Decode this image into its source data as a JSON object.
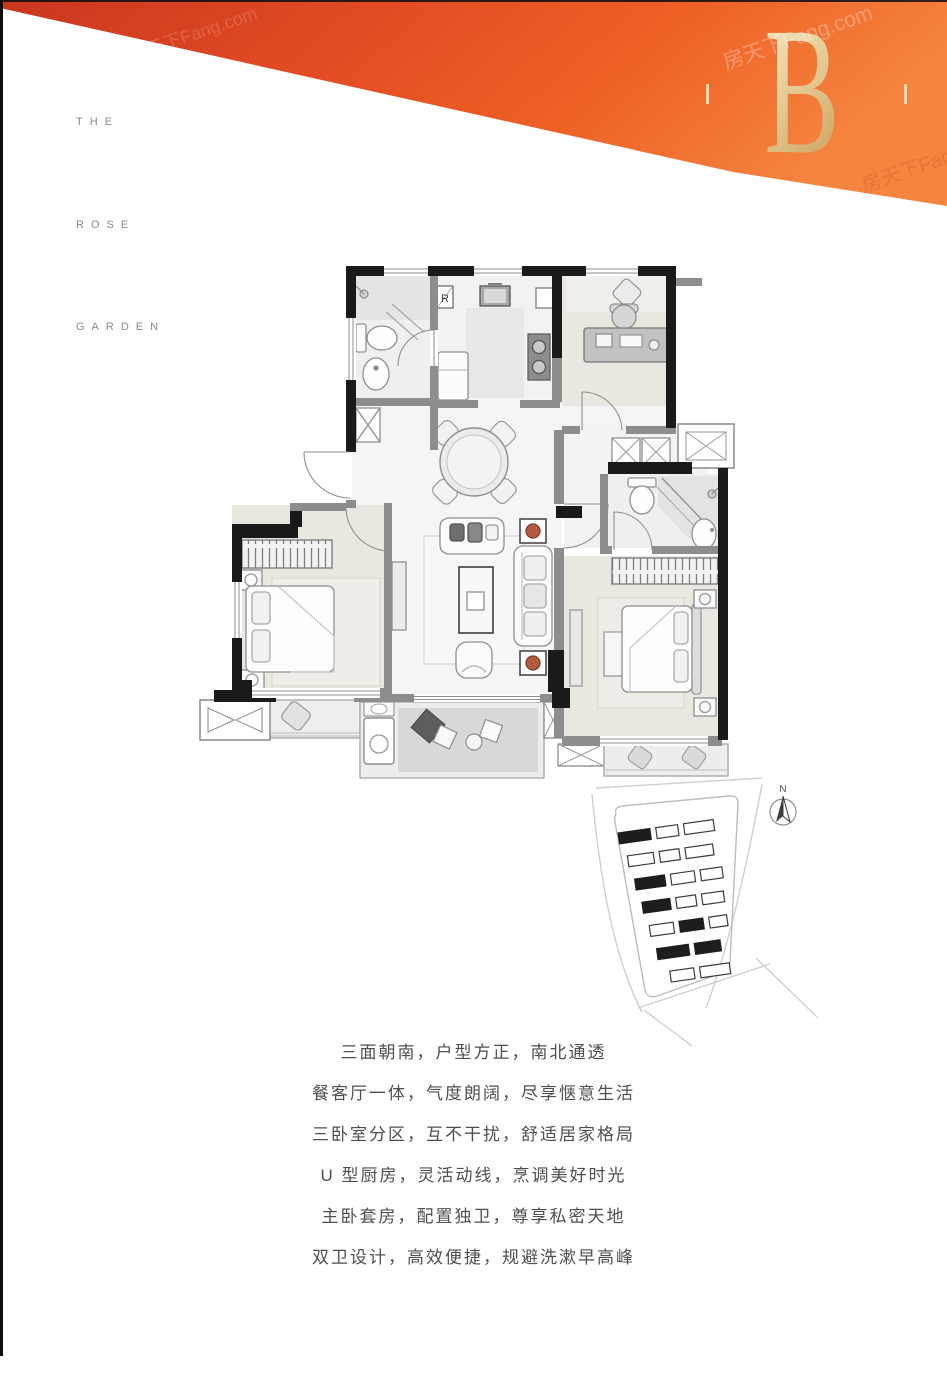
{
  "banner": {
    "unit_letter": "B"
  },
  "brand": {
    "word_1": "THE",
    "word_2": "ROSE",
    "word_3": "GARDEN"
  },
  "watermark": {
    "text": "房天下Fang.com"
  },
  "floor_plan": {
    "fridge_label": "R"
  },
  "site_plan": {
    "compass_label": "N"
  },
  "description": {
    "lines": [
      "三面朝南，户型方正，南北通透",
      "餐客厅一体，气度朗阔，尽享惬意生活",
      "三卧室分区，互不干扰，舒适居家格局",
      "U 型厨房，灵活动线，烹调美好时光",
      "主卧套房，配置独卫，尊享私密天地",
      "双卫设计，高效便捷，规避洗漱早高峰"
    ]
  },
  "colors": {
    "banner_red": "#d23b1e",
    "banner_orange": "#f58540",
    "gold": "#e8c88e",
    "wall": "#1a1a1a",
    "body_text": "#4f4f4f"
  }
}
